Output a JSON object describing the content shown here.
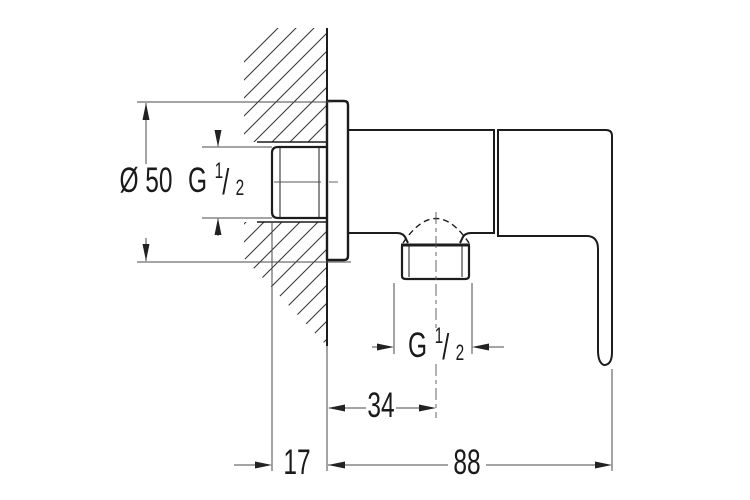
{
  "drawing": {
    "labels": {
      "diameter": "Ø 50",
      "thread_wall": "G 1/2",
      "thread_outlet": "G 1/2",
      "depth": "17",
      "outlet_offset": "34",
      "body_width": "88"
    },
    "fraction_parts": {
      "prefix": "G",
      "numerator": "1",
      "separator": "/",
      "denominator": "2"
    },
    "colors": {
      "object_line": "#1c1c1c",
      "dimension_line": "#4a4a4a",
      "background": "#ffffff"
    }
  }
}
